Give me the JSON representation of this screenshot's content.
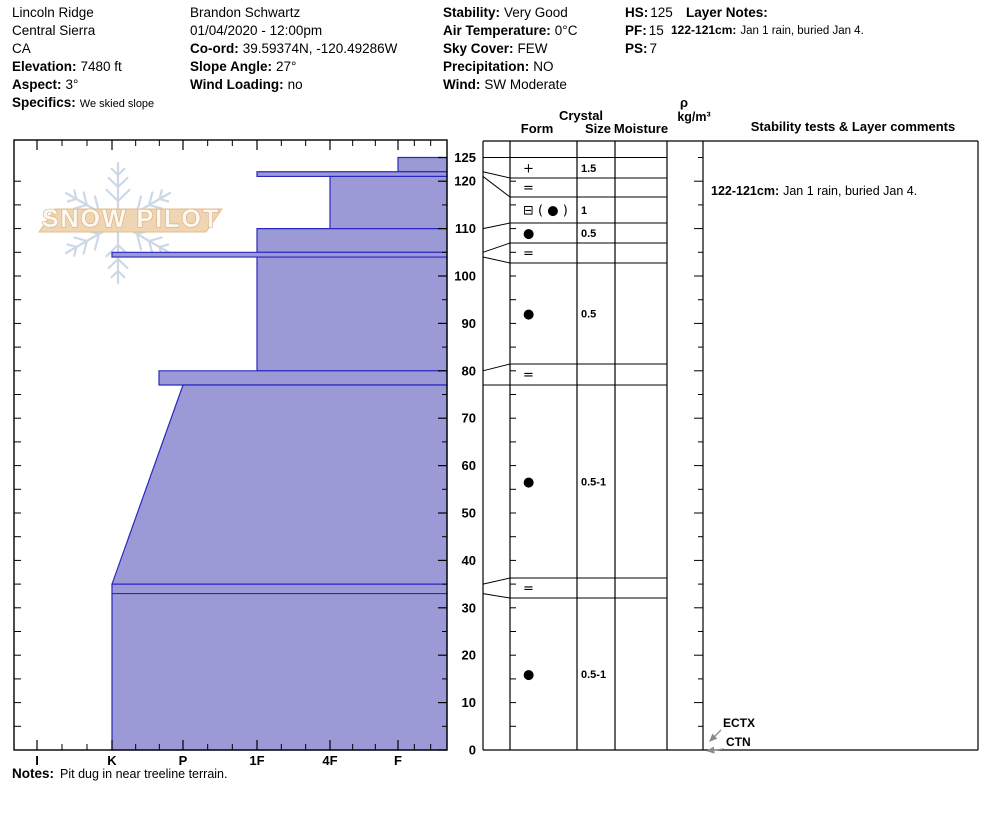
{
  "header": {
    "site": {
      "name": "Lincoln Ridge",
      "region": "Central Sierra",
      "state": "CA",
      "elevation_label": "Elevation:",
      "elevation_value": "7480 ft",
      "aspect_label": "Aspect:",
      "aspect_value": "3°",
      "specifics_label": "Specifics:",
      "specifics_value": "We skied slope"
    },
    "observer": {
      "name": "Brandon Schwartz",
      "datetime": "01/04/2020 - 12:00pm",
      "coord_label": "Co-ord:",
      "coord_value": "39.59374N, -120.49286W",
      "slope_angle_label": "Slope Angle:",
      "slope_angle_value": "27°",
      "wind_loading_label": "Wind Loading:",
      "wind_loading_value": "no"
    },
    "conditions": {
      "stability_label": "Stability:",
      "stability_value": "Very Good",
      "air_temp_label": "Air Temperature:",
      "air_temp_value": "0°C",
      "sky_cover_label": "Sky Cover:",
      "sky_cover_value": "FEW",
      "precip_label": "Precipitation:",
      "precip_value": "NO",
      "wind_label": "Wind:",
      "wind_value": "SW Moderate"
    },
    "summary": {
      "hs_label": "HS:",
      "hs_value": "125",
      "pf_label": "PF:",
      "pf_value": "15",
      "ps_label": "PS:",
      "ps_value": "7"
    },
    "layer_notes": {
      "title": "Layer Notes:",
      "entry_label": "122-121cm:",
      "entry_text": "Jan 1 rain, buried Jan 4."
    }
  },
  "logo": {
    "text": "SNOW PILOT"
  },
  "table": {
    "crystal": "Crystal",
    "form": "Form",
    "size": "Size",
    "moisture": "Moisture",
    "rho": "ρ",
    "rho_unit": "kg/m³",
    "comments": "Stability tests & Layer comments",
    "comment_entry_label": "122-121cm:",
    "comment_entry_text": "Jan 1 rain, buried Jan 4."
  },
  "notes": {
    "label": "Notes:",
    "text": "Pit dug in near treeline terrain."
  },
  "colors": {
    "layer_fill": "#9b9ad6",
    "layer_stroke": "#2a28c0",
    "arrow": "#8a8a8a",
    "snowflake": "#c7d5e3",
    "logo_band": "#f0d5b2",
    "logo_band_stroke": "#e2bd90"
  },
  "chart_data": {
    "type": "snow-profile-bar",
    "title": "Snowpit hardness profile with crystal form, size and layer comments",
    "depth_axis": {
      "unit": "cm",
      "max": 125,
      "label_values": [
        125,
        120,
        110,
        100,
        90,
        80,
        70,
        60,
        50,
        40,
        30,
        20,
        10,
        0
      ]
    },
    "hardness_axis": {
      "labels": [
        "I",
        "K",
        "P",
        "1F",
        "4F",
        "F"
      ],
      "positions_px": [
        37,
        112,
        183,
        257,
        330,
        398
      ]
    },
    "layers": [
      {
        "top_cm": 125,
        "bottom_cm": 122,
        "hardness": "F",
        "form": "+",
        "size_mm": "1.5",
        "x_top": 398,
        "x_bottom": 398,
        "row_px": [
          157.5,
          178
        ]
      },
      {
        "top_cm": 122,
        "bottom_cm": 121,
        "hardness": "1F",
        "form": "=",
        "size_mm": "",
        "x_top": 257,
        "x_bottom": 257,
        "row_px": [
          178,
          197
        ]
      },
      {
        "top_cm": 121,
        "bottom_cm": 110,
        "hardness": "4F",
        "form": "⊟ ( ● )",
        "size_mm": "1",
        "x_top": 330,
        "x_bottom": 330,
        "row_px": [
          197,
          223
        ]
      },
      {
        "top_cm": 110,
        "bottom_cm": 105,
        "hardness": "1F",
        "form": "●",
        "size_mm": "0.5",
        "x_top": 257,
        "x_bottom": 257,
        "row_px": [
          223,
          243
        ]
      },
      {
        "top_cm": 105,
        "bottom_cm": 104,
        "hardness": "K",
        "form": "=",
        "size_mm": "",
        "x_top": 112,
        "x_bottom": 112,
        "row_px": [
          243,
          263
        ]
      },
      {
        "top_cm": 104,
        "bottom_cm": 80,
        "hardness": "1F",
        "form": "●",
        "size_mm": "0.5",
        "x_top": 257,
        "x_bottom": 257,
        "row_px": [
          263,
          364
        ]
      },
      {
        "top_cm": 80,
        "bottom_cm": 77,
        "hardness": "P+",
        "form": "=",
        "size_mm": "",
        "x_top": 159,
        "x_bottom": 159,
        "row_px": [
          364,
          385
        ]
      },
      {
        "top_cm": 77,
        "bottom_cm": 35,
        "hardness": "P→K",
        "form": "●",
        "size_mm": "0.5-1",
        "x_top": 183,
        "x_bottom": 112,
        "row_px": [
          385,
          578
        ]
      },
      {
        "top_cm": 35,
        "bottom_cm": 33,
        "hardness": "K",
        "form": "=",
        "size_mm": "",
        "x_top": 112,
        "x_bottom": 112,
        "row_px": [
          578,
          598
        ]
      },
      {
        "top_cm": 33,
        "bottom_cm": 0,
        "hardness": "K",
        "form": "●",
        "size_mm": "0.5-1",
        "x_top": 112,
        "x_bottom": 112,
        "row_px": [
          598,
          750
        ]
      }
    ],
    "stability_tests": [
      {
        "name": "ECTX"
      },
      {
        "name": "CTN"
      }
    ],
    "layer_note": {
      "range": "122-121cm",
      "text": "Jan 1 rain, buried Jan 4."
    }
  }
}
